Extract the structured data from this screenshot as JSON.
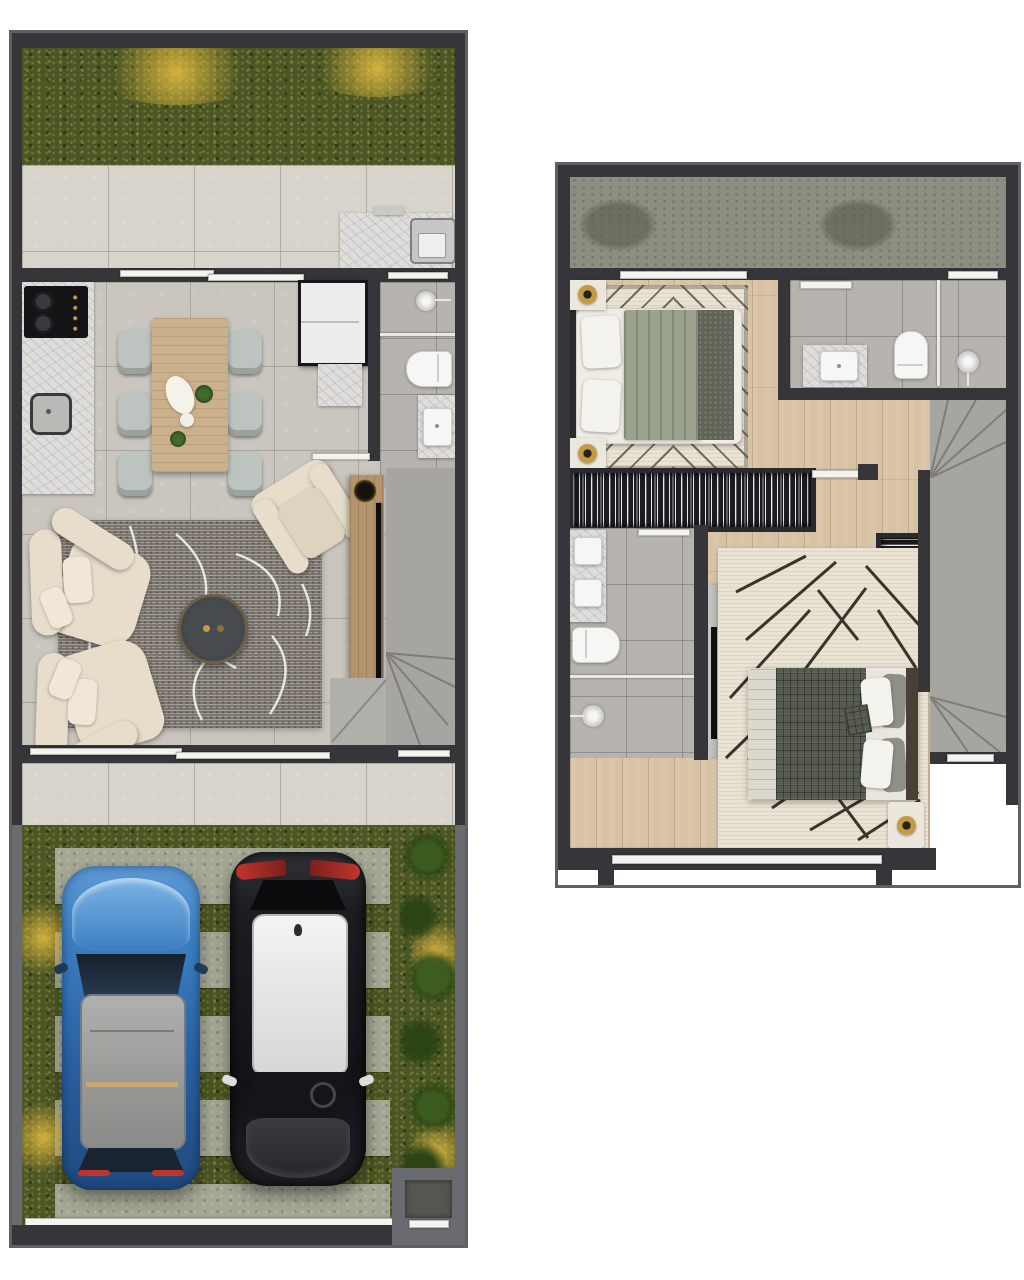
{
  "page": {
    "background": "#ffffff",
    "description": "Top-down 3D rendered floor plans of a two-storey townhouse, no text labels visible"
  },
  "colors": {
    "wall": "#35353a",
    "fence": "#6a6b70",
    "grass": "#4c5525",
    "glowYellow": "#d9b544",
    "patioTile": "#d8d4cb",
    "floorTile": "#cac6bf",
    "bathTile": "#b7b4af",
    "marble": "#dedddb",
    "woodFloor": "#d7c2a4",
    "roof": "#8b8e80",
    "stair": "#a7a5a1",
    "stairEdge": "#7f7d78",
    "fixture": "#f6f6f4",
    "wardrobe": "#1d1d21",
    "rugGray": "#98928a",
    "rugCream": "#eae2d3",
    "sofa": "#e7ddca",
    "chair": "#bdc4c0",
    "tableWood": "#cbb08c",
    "consoleWood": "#b3946c",
    "coffeeTable": "#41454a",
    "cooktop": "#141417",
    "fridge": "#ededef",
    "sage": "#9aa18c",
    "runner": "#5f6457",
    "plaid": "#565c50",
    "pillow": "#f4f2ec",
    "gold": "#c49a45",
    "tvDark": "#0e0e10",
    "concrete": "#a4a794",
    "plant": "#36511c",
    "carBlue": "#3c7fc2",
    "carBlueDark": "#1f4a7e",
    "carBlack": "#151619",
    "carRoofGray": "#a2a3a1",
    "carRoofWhite": "#eef0ef",
    "taillight": "#c03430",
    "nightstand": "#ece7dd",
    "headboard": "#2b2b2e",
    "bed2Headboard": "#4a3f34"
  },
  "ground_floor": {
    "name": "ground-floor-plan",
    "rooms": [
      "garden",
      "rear-terrace",
      "service-area",
      "kitchen",
      "dining-area",
      "living-room",
      "bathroom",
      "staircase",
      "front-patio",
      "driveway"
    ],
    "furniture": [
      "laundry-tank",
      "cooktop",
      "kitchen-sink",
      "dining-table",
      "six-dining-chairs",
      "refrigerator",
      "tall-cabinet",
      "shower",
      "toilet",
      "vanity-sink",
      "sectional-sofa",
      "round-coffee-table",
      "armchair",
      "tv-console",
      "contour-area-rug"
    ],
    "vehicles": [
      {
        "type": "car",
        "body_color": "blue",
        "roof_color": "gray"
      },
      {
        "type": "car",
        "body_color": "black",
        "roof_color": "white"
      }
    ],
    "outdoor": [
      "grass-lawn",
      "paver-strips",
      "garden-lights",
      "shrub-row",
      "entry-gate"
    ]
  },
  "upper_floor": {
    "name": "upper-floor-plan",
    "rooms": [
      "roof-slab",
      "bedroom-1",
      "bathroom-1",
      "hallway",
      "bathroom-2",
      "bedroom-2",
      "staircase"
    ],
    "furniture": [
      "double-bed-1",
      "two-nightstands-with-gold-lamps",
      "chevron-rug",
      "wardrobe-1",
      "vanity-sink-1",
      "toilet-1",
      "shower-1",
      "double-vanity",
      "toilet-2",
      "shower-2",
      "tv-panel",
      "wardrobe-2",
      "geometric-rug",
      "double-bed-2",
      "nightstand-with-gold-lamp"
    ]
  }
}
